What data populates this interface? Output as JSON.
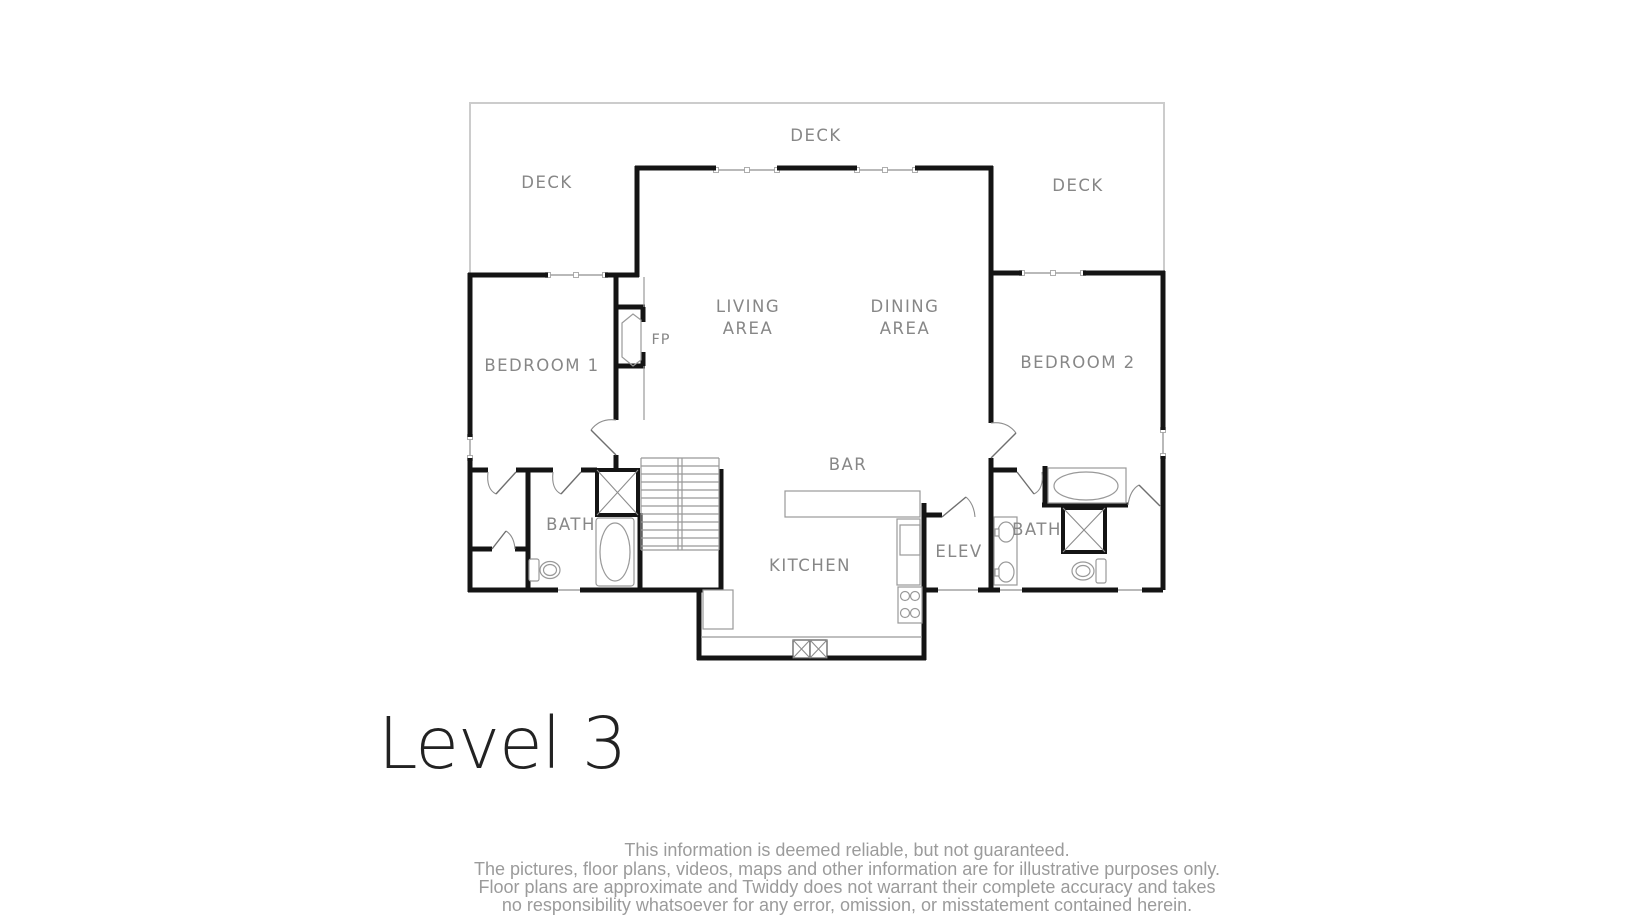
{
  "page": {
    "background": "#ffffff"
  },
  "title": {
    "text": "Level 3"
  },
  "plan": {
    "labels": {
      "deck_top": "DECK",
      "deck_left": "DECK",
      "deck_right": "DECK",
      "living_line1": "LIVING",
      "living_line2": "AREA",
      "dining_line1": "DINING",
      "dining_line2": "AREA",
      "bedroom1": "BEDROOM 1",
      "bedroom2": "BEDROOM 2",
      "bath_left": "BATH",
      "bath_right": "BATH",
      "kitchen": "KITCHEN",
      "bar": "BAR",
      "elevator": "ELEV",
      "fireplace": "FP"
    },
    "colors": {
      "wall": "#141414",
      "fixture_outline": "#999999",
      "window": "#b9b9b9",
      "deck_outline": "#cccccc",
      "room_label": "#878787",
      "title_text": "#222222",
      "footer_text": "#9b9b9b"
    }
  },
  "footer": {
    "lines": [
      "This information is deemed reliable, but not guaranteed.",
      "The pictures, floor plans, videos, maps and other information are for illustrative purposes only.",
      "Floor plans are approximate and Twiddy does not warrant their complete accuracy and takes",
      "no responsibility whatsoever for any error, omission, or misstatement contained herein."
    ]
  }
}
